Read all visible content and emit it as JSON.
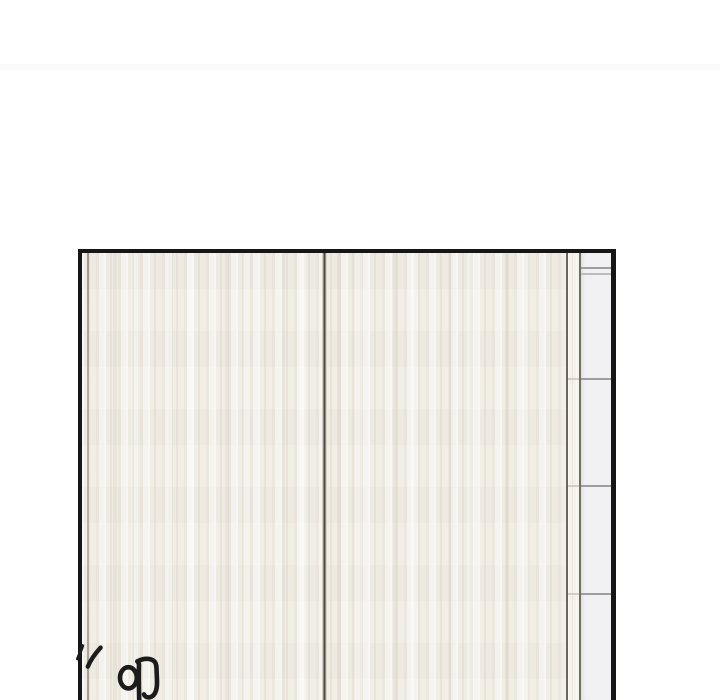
{
  "meta": {
    "width_px": 720,
    "height_px": 700,
    "content": "Manhwa page crop: white top gutter with a very faint page-seam band, then the upper portion of a borderless-bottom panel showing closed wardrobe sliding doors (cream vertical wood grain, dark center seam) with a narrow frame strip and a light-gray shelf column with horizontal shelf dividers along the right edge; a partially cut-off hand-drawn sound effect sits at the bottom-left."
  },
  "colors": {
    "page_bg": "#ffffff",
    "separator_band": "#fafafa",
    "panel_border": "#161616",
    "wood_base": "#f1eee6",
    "seam_dark": "#4f4b44",
    "frame_line": "#6b655a",
    "frame_strip_bg": "#f5f2ea",
    "shelf_strip_bg": "#f1f1f4",
    "shelf_divider": "#9d9d9d",
    "sfx_ink": "#1c1c1c"
  },
  "panel": {
    "label": "wardrobe sliding doors with right shelf column",
    "shelf_divider_count": 4,
    "shelf_segments_visible": 5
  },
  "sfx": {
    "visible_text": "'' oΠ",
    "description": "two motion ticks plus a partial hangul-style sound-effect glyph, cut off by the bottom edge of the image"
  }
}
